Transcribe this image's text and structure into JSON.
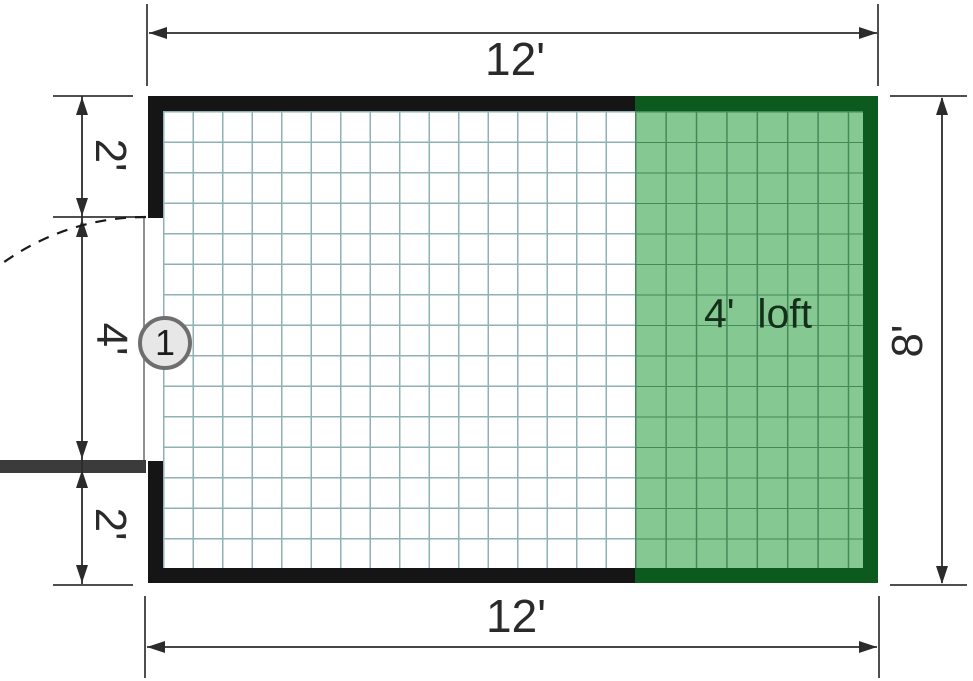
{
  "floor_plan": {
    "dimensions": {
      "top": "12'",
      "bottom": "12'",
      "right": "8'",
      "left_top": "2'",
      "left_middle": "4'",
      "left_bottom": "2'"
    },
    "loft_label": "4'  loft",
    "door_marker": "1",
    "dimensions_feet": {
      "width": 12,
      "height": 8,
      "loft_depth": 4,
      "door_opening": 4,
      "top_wall_segment": 2,
      "bottom_wall_segment": 2
    },
    "colors": {
      "wall": "#151515",
      "loft_wall": "#0c5a1d",
      "loft_fill": "#86c891",
      "loft_grid_line": "#44895a",
      "grid_line": "#8fb0b4",
      "door_leaf": "#3b3b3b",
      "dimension_ink": "#2b2b2b",
      "marker_fill": "#e7e7e7",
      "marker_border": "#6e6e6e"
    }
  }
}
